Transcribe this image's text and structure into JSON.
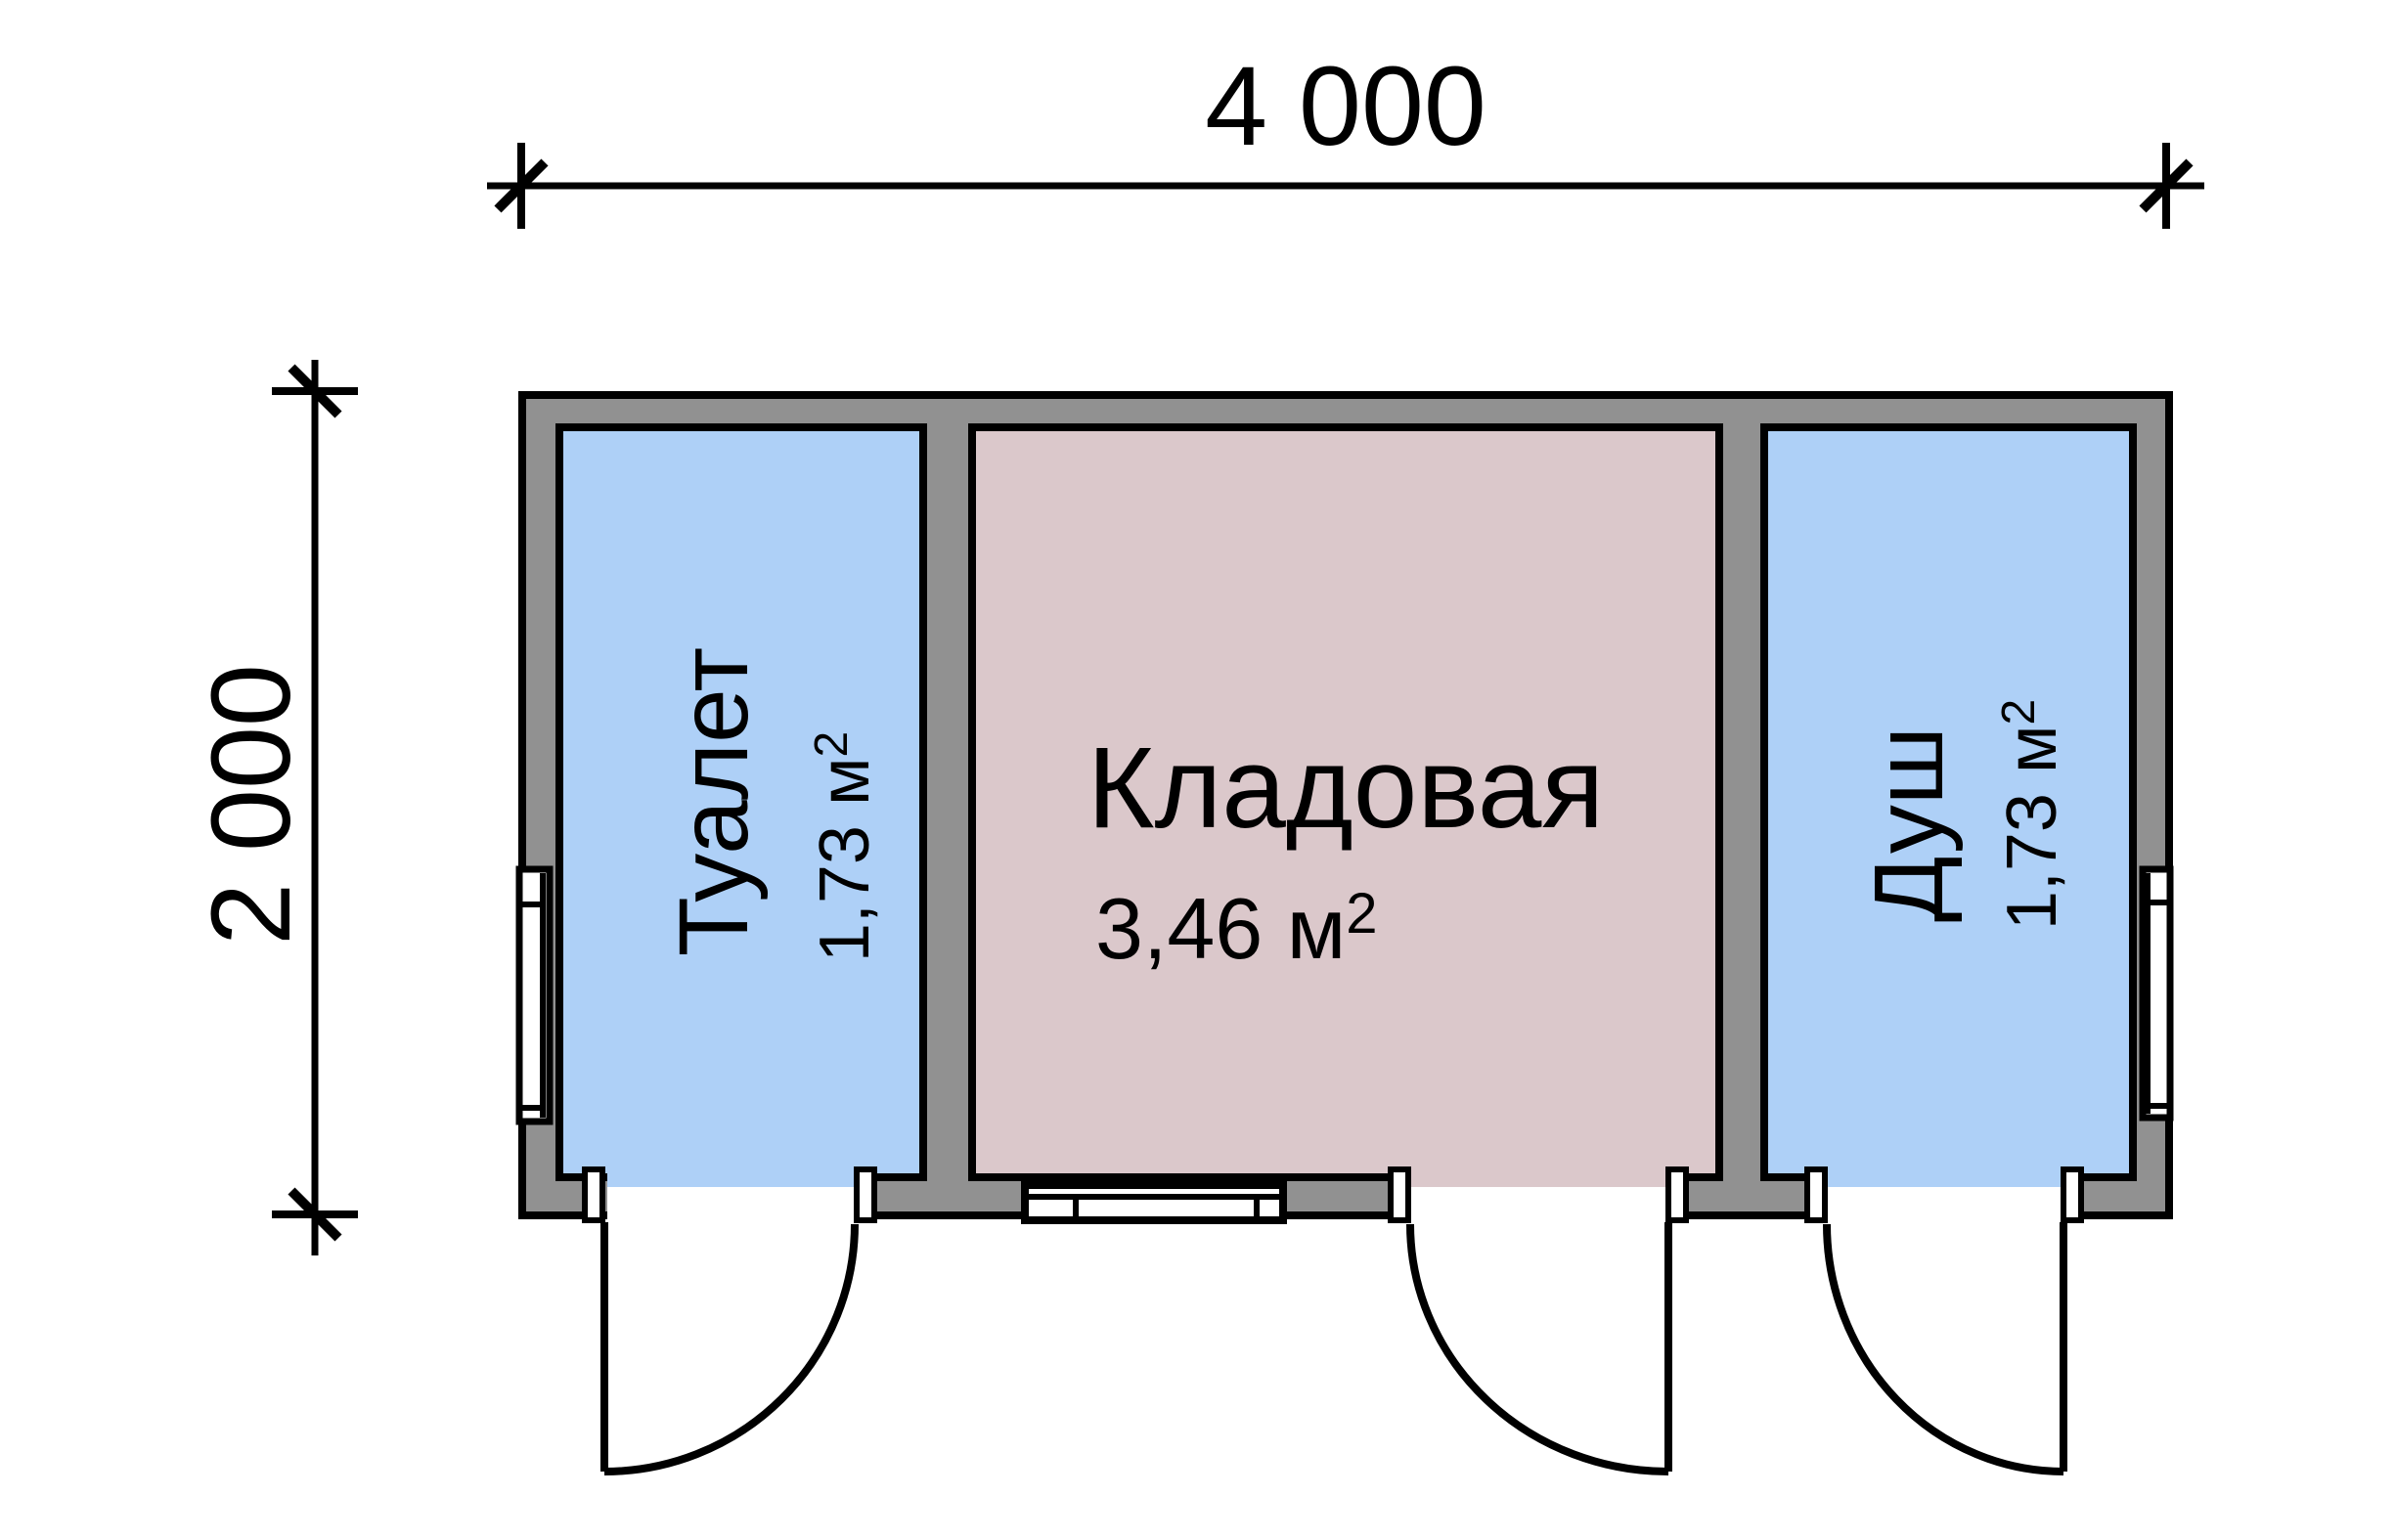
{
  "dimensions": {
    "top_label": "4 000",
    "left_label": "2 000"
  },
  "rooms": [
    {
      "name": "Туалет",
      "area": "1,73 м",
      "area_sup": "2",
      "fill": "#aed0f7"
    },
    {
      "name": "Кладовая",
      "area": "3,46 м",
      "area_sup": "2",
      "fill": "#dbc8cb"
    },
    {
      "name": "Душ",
      "area": "1,73 м",
      "area_sup": "2",
      "fill": "#aed0f7"
    }
  ],
  "colors": {
    "background": "#ffffff",
    "wall": "#919191",
    "line": "#000000",
    "window": "#ffffff"
  }
}
